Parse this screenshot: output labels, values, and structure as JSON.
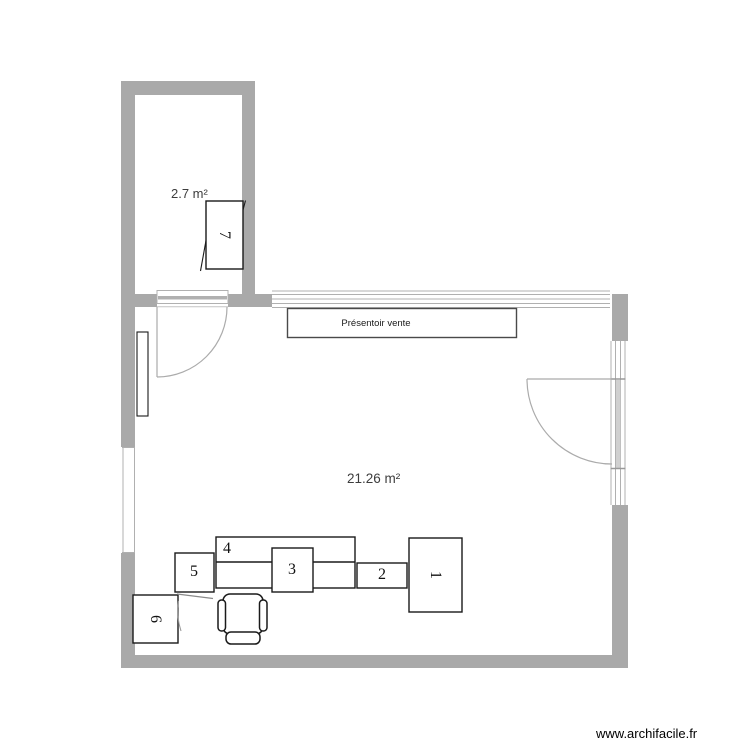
{
  "watermark": "www.archifacile.fr",
  "rooms": {
    "annex": {
      "area_label": "2.7 m²"
    },
    "main": {
      "area_label": "21.26 m²"
    }
  },
  "objects": {
    "display_stand_label": "Présentoir vente"
  },
  "furniture_labels": {
    "item1": "1",
    "item2": "2",
    "item3": "3",
    "item4": "4",
    "item5": "5",
    "item6": "6",
    "item7": "7"
  },
  "colors": {
    "wall": "#a9a9a9",
    "window_line": "#b0b0b0",
    "door_arc": "#ababab",
    "furniture_outline": "#1a1a1a",
    "label_text": "#3d3d3d"
  }
}
